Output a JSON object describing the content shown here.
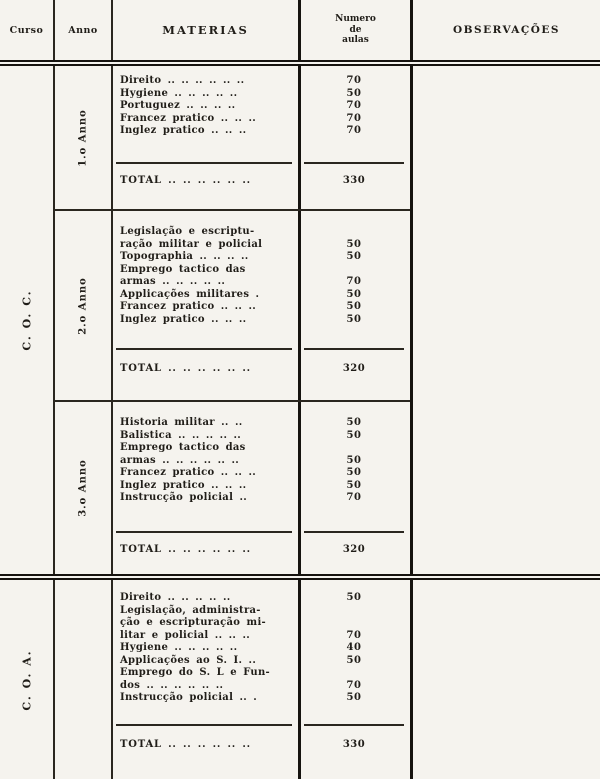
{
  "colors": {
    "paper": "#f5f3ee",
    "ink": "#201d18"
  },
  "header": {
    "curso": "Curso",
    "anno": "Anno",
    "materias": "MATERIAS",
    "numero_lines": [
      "Numero",
      "de",
      "aulas"
    ],
    "observacoes": "OBSERVAÇÕES"
  },
  "groups": [
    {
      "curso": "C. O. C.",
      "sections": [
        {
          "anno": "1.o Anno",
          "subjects": [
            {
              "lines": [
                "Direito .. .. .. .. .. .."
              ],
              "value": "70"
            },
            {
              "lines": [
                "Hygiene .. .. .. .. .."
              ],
              "value": "50"
            },
            {
              "lines": [
                "Portuguez .. .. .. .."
              ],
              "value": "70"
            },
            {
              "lines": [
                "Francez pratico .. .. .."
              ],
              "value": "70"
            },
            {
              "lines": [
                "Inglez pratico .. .. .."
              ],
              "value": "70"
            }
          ],
          "total_label": "TOTAL .. .. .. .. .. ..",
          "total_value": "330"
        },
        {
          "anno": "2.o Anno",
          "subjects": [
            {
              "lines": [
                "Legislação e escriptu-",
                "ração militar e policial"
              ],
              "value": "50"
            },
            {
              "lines": [
                "Topographia .. .. .. .."
              ],
              "value": "50"
            },
            {
              "lines": [
                "Emprego tactico das",
                "armas .. .. .. .. .."
              ],
              "value": "70"
            },
            {
              "lines": [
                "Applicações militares ."
              ],
              "value": "50"
            },
            {
              "lines": [
                "Francez pratico .. .. .."
              ],
              "value": "50"
            },
            {
              "lines": [
                "Inglez pratico .. .. .."
              ],
              "value": "50"
            }
          ],
          "total_label": "TOTAL .. .. .. .. .. ..",
          "total_value": "320"
        },
        {
          "anno": "3.o Anno",
          "subjects": [
            {
              "lines": [
                "Historia militar .. .."
              ],
              "value": "50"
            },
            {
              "lines": [
                "Balistica .. .. .. .. .."
              ],
              "value": "50"
            },
            {
              "lines": [
                "Emprego tactico das",
                "armas .. .. .. .. .. .."
              ],
              "value": "50"
            },
            {
              "lines": [
                "Francez pratico .. .. .."
              ],
              "value": "50"
            },
            {
              "lines": [
                "Inglez pratico .. .. .."
              ],
              "value": "50"
            },
            {
              "lines": [
                "Instrucção policial .."
              ],
              "value": "70"
            }
          ],
          "total_label": "TOTAL .. .. .. .. .. ..",
          "total_value": "320"
        }
      ]
    },
    {
      "curso": "C. O. A.",
      "sections": [
        {
          "anno": "",
          "subjects": [
            {
              "lines": [
                "Direito .. .. .. .. .."
              ],
              "value": "50"
            },
            {
              "lines": [
                "Legislação, administra-",
                "ção e escripturação mi-",
                "litar e policial .. .. .."
              ],
              "value": "70"
            },
            {
              "lines": [
                "Hygiene .. .. .. .. .."
              ],
              "value": "40"
            },
            {
              "lines": [
                "Applicações ao S. I. .."
              ],
              "value": "50"
            },
            {
              "lines": [
                "Emprego do S. L e Fun-",
                "dos .. .. .. .. .. .."
              ],
              "value": "70"
            },
            {
              "lines": [
                "Instrucção policial .. ."
              ],
              "value": "50"
            }
          ],
          "total_label": "TOTAL .. .. .. .. .. ..",
          "total_value": "330"
        }
      ]
    }
  ]
}
